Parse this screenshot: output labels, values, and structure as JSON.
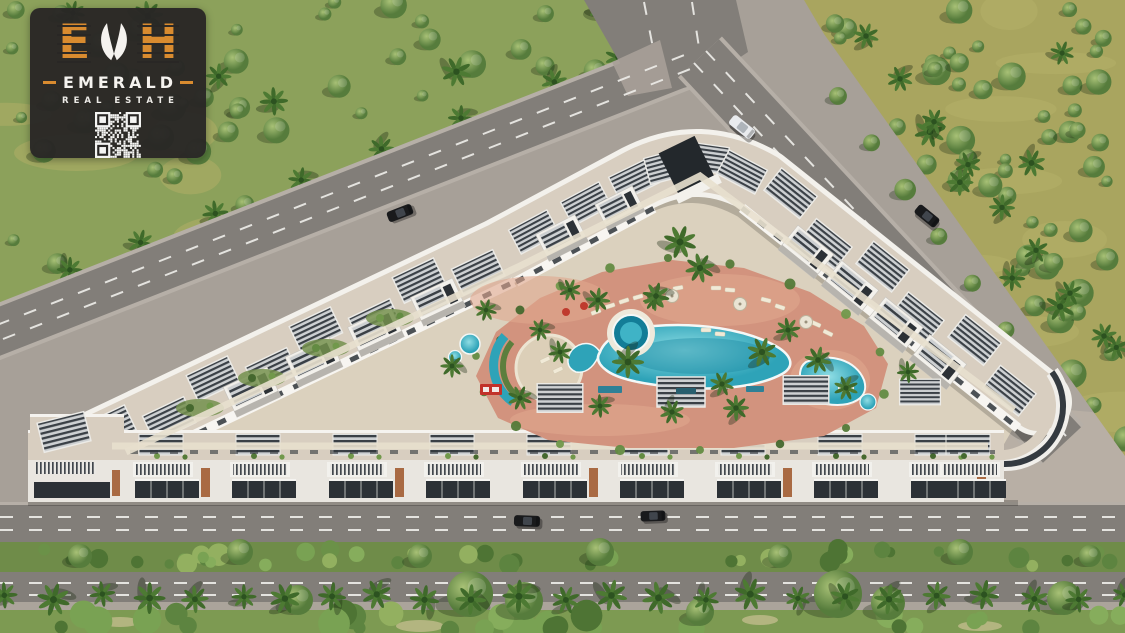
{
  "badge": {
    "monogram_left": "E",
    "monogram_right": "H",
    "name": "EMERALD",
    "tagline": "REAL ESTATE",
    "accent_color": "#d98b2f",
    "background_color": "#292725",
    "text_color": "#f5f3ef"
  },
  "scene": {
    "palette": {
      "pavement": "#a7a098",
      "pavement_light": "#b4aba0",
      "asphalt": "#827e79",
      "sidewalk": "#b6afa7",
      "lane_marking": "#edece8",
      "forest_base": "#8ca15b",
      "dry_grass": "#a9a55f",
      "grass_patch": "#b4b068",
      "median_green": "#6f8c49",
      "bottom_green": "#7d9a52",
      "courtyard": "#dbd1be",
      "roof": "#d8cec0",
      "building_white": "#f3f1ec",
      "facade_light": "#e9e6e0",
      "glass_dark": "#2c3136",
      "pergola_slat": "#3a4046",
      "pergola_frame": "#ecebe7",
      "accent_brown": "#a96a43",
      "terracotta": "#d2937e",
      "terracotta_light": "#dfa68e",
      "pool_water": "#2ea3b8",
      "pool_deep": "#1f8ba4",
      "pool_rim": "#f4f8f7",
      "spa_dark": "#137d97",
      "sign_red": "#c2322a",
      "sign_teal": "#2e8096",
      "car_dark": "#191a1c",
      "car_white": "#e9ebee",
      "palm_green": "#48752f",
      "shadow": "rgba(0,0,0,0.2)"
    }
  }
}
